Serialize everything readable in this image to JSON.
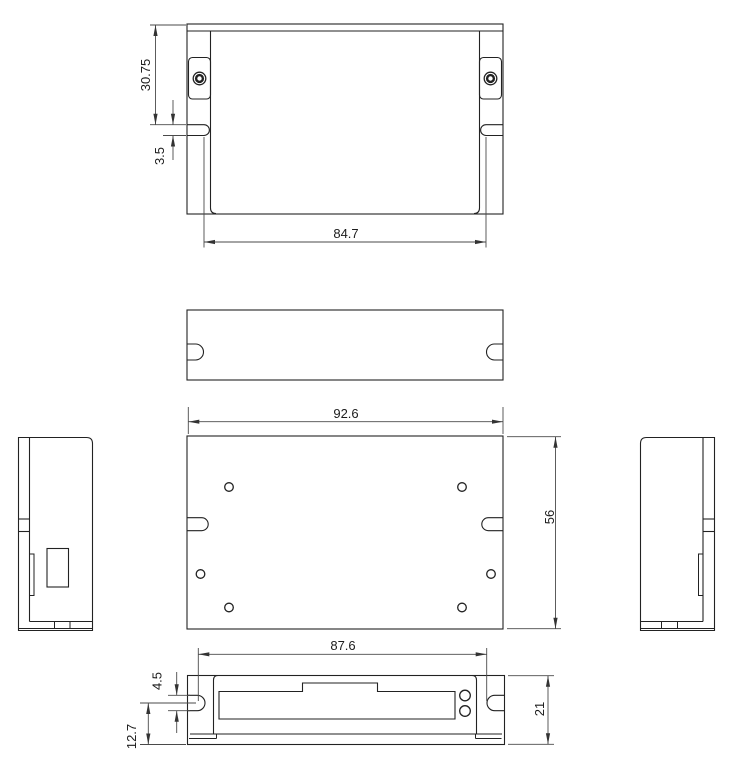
{
  "colors": {
    "background": "#ffffff",
    "line": "#222222",
    "dim": "#4a4a4a"
  },
  "drawing": {
    "type": "mechanical-orthographic-views",
    "views": [
      "top-view",
      "top-face-view",
      "base-plate-view",
      "front-view",
      "left-side-view",
      "right-side-view"
    ],
    "dims": {
      "mount_hole_offset": "30.75",
      "top_slot_height": "3.5",
      "top_slot_span": "84.7",
      "body_width": "92.6",
      "body_depth": "56",
      "front_slot_span": "87.6",
      "front_slot_height": "4.5",
      "slot_center_to_base": "12.7",
      "front_height": "21"
    }
  }
}
